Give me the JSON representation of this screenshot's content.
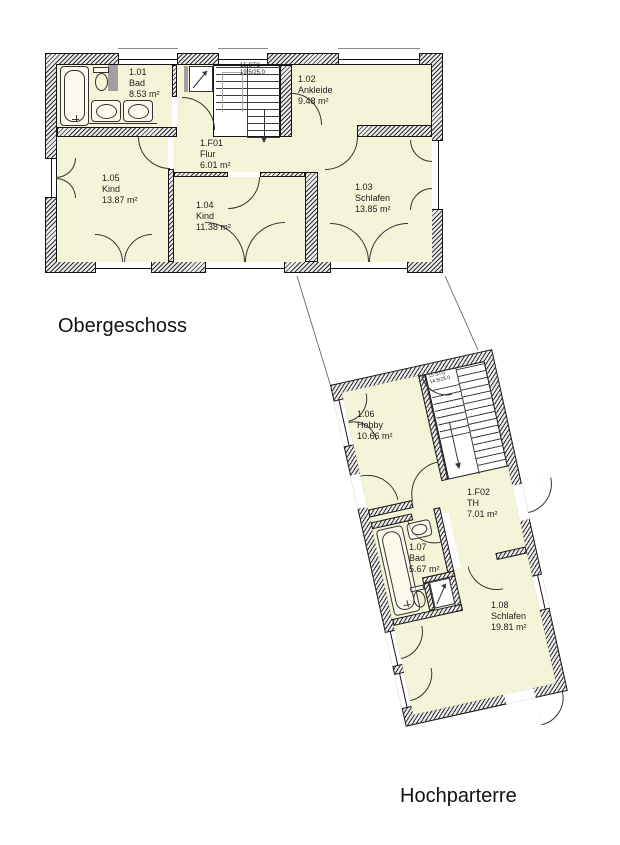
{
  "colors": {
    "room_fill": "#f6f4d8",
    "wall_line": "#141414",
    "hatch": "#2e2e2e",
    "background": "#ffffff"
  },
  "plans": {
    "obergeschoss": {
      "title": "Obergeschoss",
      "stairs": {
        "line1": "15 STG",
        "line2": "19.5/25.0"
      },
      "rooms": [
        {
          "id": "1.01",
          "name": "Bad",
          "area": "8.53 m²"
        },
        {
          "id": "1.02",
          "name": "Ankleide",
          "area": "9.48 m²"
        },
        {
          "id": "1.F01",
          "name": "Flur",
          "area": "6.01 m²"
        },
        {
          "id": "1.05",
          "name": "Kind",
          "area": "13.87 m²"
        },
        {
          "id": "1.04",
          "name": "Kind",
          "area": "11.38 m²"
        },
        {
          "id": "1.03",
          "name": "Schlafen",
          "area": "13.85 m²"
        }
      ]
    },
    "hochparterre": {
      "title": "Hochparterre",
      "stairs": {
        "line1": "15 STG",
        "line2": "14.5/25.0"
      },
      "rooms": [
        {
          "id": "1.06",
          "name": "Hobby",
          "area": "10.66 m²"
        },
        {
          "id": "1.F02",
          "name": "TH",
          "area": "7.01 m²"
        },
        {
          "id": "1.07",
          "name": "Bad",
          "area": "5.67 m²"
        },
        {
          "id": "1.08",
          "name": "Schlafen",
          "area": "19.81 m²"
        }
      ]
    }
  }
}
